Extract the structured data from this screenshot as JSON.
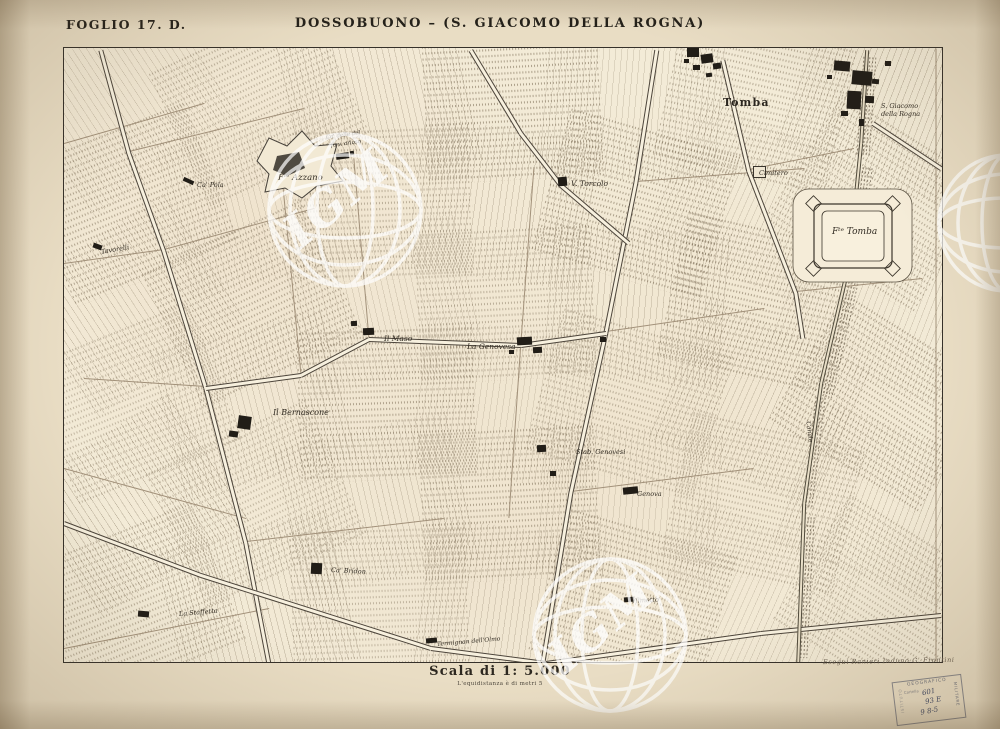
{
  "header": {
    "folio": "FOGLIO 17. D.",
    "title": "DOSSOBUONO – (S. GIACOMO DELLA ROGNA)"
  },
  "footer": {
    "scale_label": "Scala di 1: 5.000",
    "equidistance_note": "L'equidistanza è di metri 5",
    "engraver_signature": "Eseguì Ranieri Induno G. Frontini"
  },
  "stamp": {
    "top": "GEOGRAFICO",
    "right": "MILITARE",
    "left": "ISTITUTO",
    "row_label": "Cartella",
    "num1": "601",
    "num2": "93 E",
    "num3": "9 8-5"
  },
  "watermark_text": "IGM",
  "map": {
    "labels": [
      {
        "text": "Tomba",
        "x": 659,
        "y": 48,
        "size": 11,
        "rot": 0,
        "cls": "roman"
      },
      {
        "text": "S. Giacomo",
        "x": 817,
        "y": 54,
        "size": 6.5,
        "rot": 0,
        "cls": "ital"
      },
      {
        "text": "della Rogna",
        "x": 817,
        "y": 62,
        "size": 6.5,
        "rot": 0,
        "cls": "ital"
      },
      {
        "text": "Cimitero",
        "x": 695,
        "y": 121,
        "size": 6.5,
        "rot": 0,
        "cls": "ital"
      },
      {
        "text": "Fᵗᵉ Tomba",
        "x": 768,
        "y": 179,
        "size": 9,
        "rot": 0,
        "cls": "ital"
      },
      {
        "text": "Fᵗᵉ Azzano",
        "x": 214,
        "y": 125,
        "size": 8.5,
        "rot": 0,
        "cls": "ital"
      },
      {
        "text": "Ca' delle del",
        "x": 262,
        "y": 87,
        "size": 5.5,
        "rot": -8,
        "cls": "ital"
      },
      {
        "text": "fu v. arioso",
        "x": 267,
        "y": 95,
        "size": 5.5,
        "rot": -8,
        "cls": "ital"
      },
      {
        "text": "V. Torcolo",
        "x": 507,
        "y": 131,
        "size": 7.5,
        "rot": 0,
        "cls": "ital"
      },
      {
        "text": "Ca' Pola",
        "x": 133,
        "y": 133,
        "size": 6.5,
        "rot": 0,
        "cls": "ital"
      },
      {
        "text": "Tavorelli",
        "x": 37,
        "y": 200,
        "size": 6.5,
        "rot": -10,
        "cls": "ital"
      },
      {
        "text": "Il Maso",
        "x": 320,
        "y": 286,
        "size": 7.5,
        "rot": 0,
        "cls": "ital"
      },
      {
        "text": "La Genovesa",
        "x": 403,
        "y": 294,
        "size": 7.5,
        "rot": 0,
        "cls": "ital"
      },
      {
        "text": "Il Bernascone",
        "x": 209,
        "y": 360,
        "size": 8,
        "rot": 0,
        "cls": "ital"
      },
      {
        "text": "Stab. Genovesi",
        "x": 512,
        "y": 400,
        "size": 6.5,
        "rot": 0,
        "cls": "ital"
      },
      {
        "text": "Genova",
        "x": 573,
        "y": 442,
        "size": 6.5,
        "rot": 0,
        "cls": "ital"
      },
      {
        "text": "Ca' Bridon",
        "x": 267,
        "y": 518,
        "size": 6.5,
        "rot": 3,
        "cls": "ital"
      },
      {
        "text": "La Staffetta",
        "x": 115,
        "y": 562,
        "size": 6.5,
        "rot": -5,
        "cls": "ital"
      },
      {
        "text": "Termignan dell'Olmo",
        "x": 373,
        "y": 593,
        "size": 6,
        "rot": -5,
        "cls": "ital"
      },
      {
        "text": "Vilmetto",
        "x": 567,
        "y": 549,
        "size": 6.5,
        "rot": -3,
        "cls": "ital"
      },
      {
        "text": "Canale",
        "x": 744,
        "y": 370,
        "size": 6,
        "rot": 83,
        "cls": "ital"
      }
    ]
  }
}
